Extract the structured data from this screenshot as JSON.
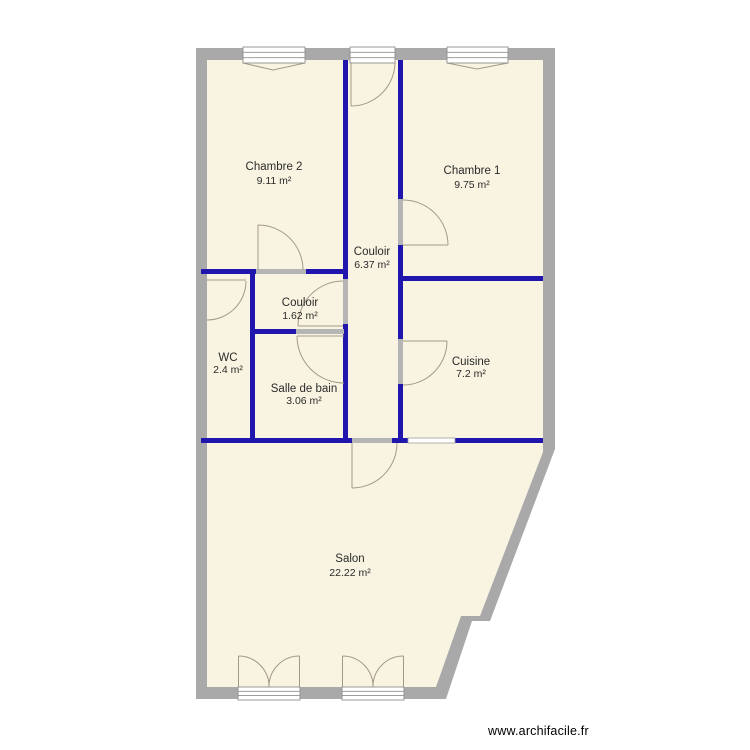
{
  "watermark": {
    "text": "www.archifacile.fr"
  },
  "colors": {
    "background": "#ffffff",
    "floor": "#f8f4e1",
    "outer_wall": "#a9a9a9",
    "partition": "#2016ae",
    "door_frame": "#b5b5b5",
    "door_arc": "#a39a85",
    "window_stroke": "#8f8f8f",
    "label": "#2b2b2b"
  },
  "rooms": [
    {
      "id": "chambre-2",
      "name": "Chambre 2",
      "area": "9.11 m²"
    },
    {
      "id": "chambre-1",
      "name": "Chambre 1",
      "area": "9.75 m²"
    },
    {
      "id": "couloir",
      "name": "Couloir",
      "area": "6.37 m²"
    },
    {
      "id": "couloir-2",
      "name": "Couloir",
      "area": "1.62 m²"
    },
    {
      "id": "wc",
      "name": "WC",
      "area": "2.4 m²"
    },
    {
      "id": "salle-de-bain",
      "name": "Salle de bain",
      "area": "3.06 m²"
    },
    {
      "id": "cuisine",
      "name": "Cuisine",
      "area": "7.2 m²"
    },
    {
      "id": "salon",
      "name": "Salon",
      "area": "22.22 m²"
    }
  ]
}
